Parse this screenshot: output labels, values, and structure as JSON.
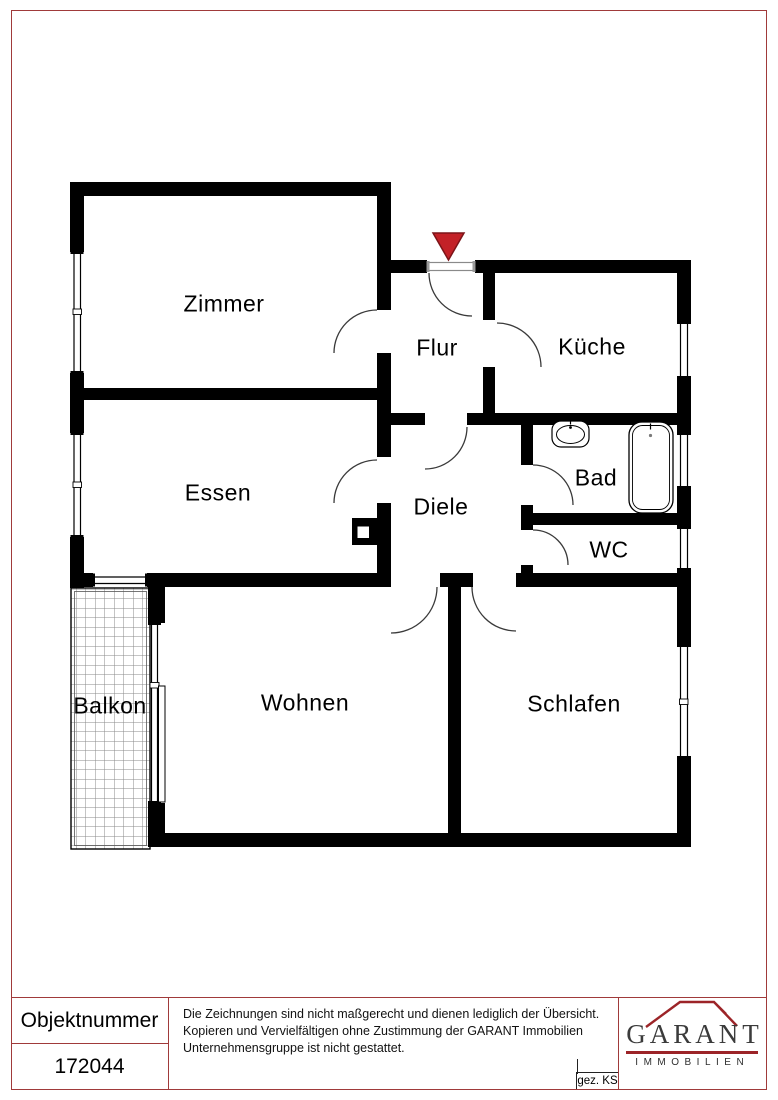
{
  "theme": {
    "frame_red": "#a03a3a",
    "logo_red": "#9c2428",
    "wall_color": "#000000",
    "entrance_marker_color": "#c32127"
  },
  "floorplan": {
    "entrance_marker": "triangle-down",
    "rooms": [
      {
        "id": "zimmer",
        "label": "Zimmer"
      },
      {
        "id": "flur",
        "label": "Flur"
      },
      {
        "id": "kueche",
        "label": "Küche"
      },
      {
        "id": "essen",
        "label": "Essen"
      },
      {
        "id": "diele",
        "label": "Diele"
      },
      {
        "id": "bad",
        "label": "Bad"
      },
      {
        "id": "wc",
        "label": "WC"
      },
      {
        "id": "balkon",
        "label": "Balkon"
      },
      {
        "id": "wohnen",
        "label": "Wohnen"
      },
      {
        "id": "schlafen",
        "label": "Schlafen"
      }
    ]
  },
  "footer": {
    "object_number_label": "Objektnummer",
    "object_number_value": "172044",
    "disclaimer_lines": [
      "Die Zeichnungen sind nicht maßgerecht und dienen lediglich der Übersicht.",
      "Kopieren und Vervielfältigen ohne Zustimmung der GARANT Immobilien",
      "Unternehmensgruppe ist nicht gestattet."
    ],
    "drawn_by": "gez. KS",
    "logo": {
      "name": "GARANT",
      "subtitle": "IMMOBILIEN"
    }
  }
}
